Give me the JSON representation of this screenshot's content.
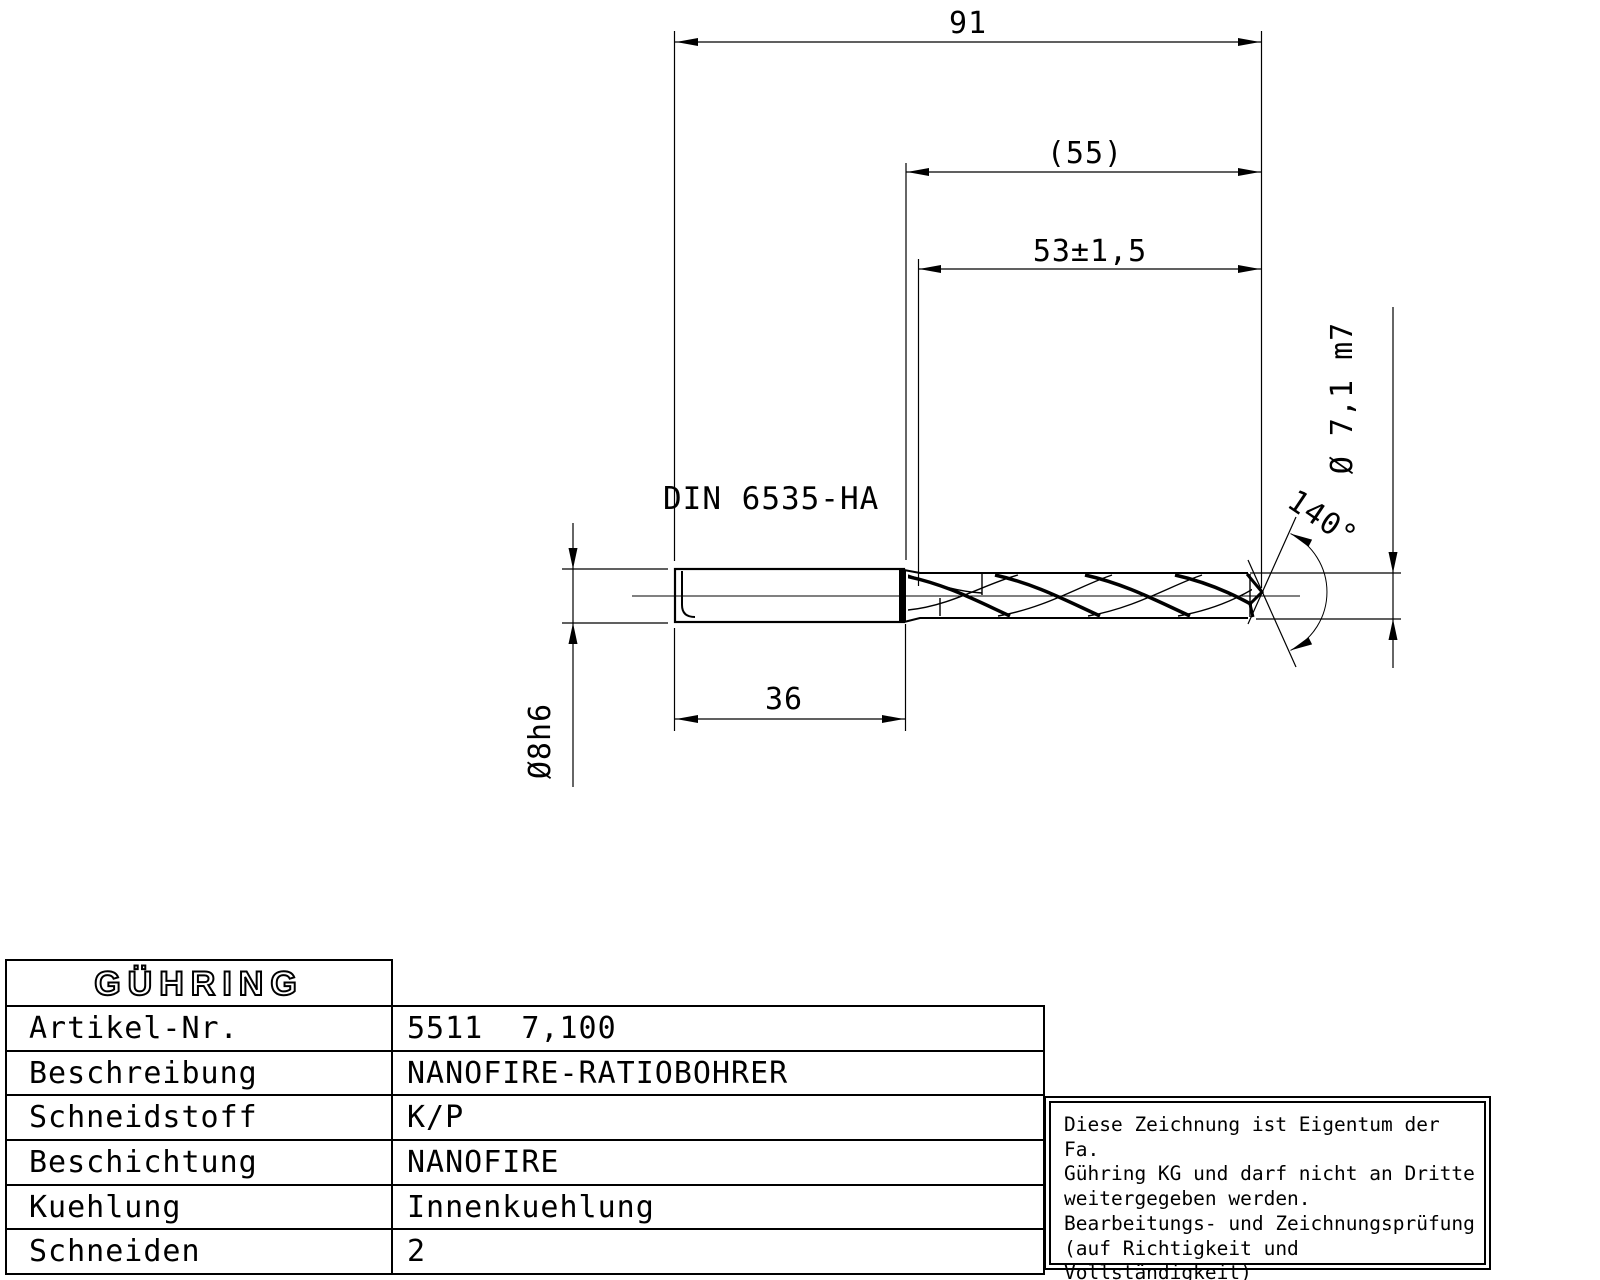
{
  "colors": {
    "ink": "#000000",
    "background": "#ffffff"
  },
  "drawing": {
    "dimensions": {
      "overall_length": "91",
      "flute_ref_length": "(55)",
      "flute_length_tol": "53±1,5",
      "point_angle": "140°",
      "drill_diameter": "Ø 7,1 m7",
      "shank_diameter": "Ø8h6",
      "shank_length": "36",
      "shank_norm": "DIN 6535-HA"
    }
  },
  "title_block": {
    "logo": "GÜHRING",
    "rows": [
      {
        "label": "Artikel-Nr.",
        "value": "5511  7,100"
      },
      {
        "label": "Beschreibung",
        "value": "NANOFIRE-RATIOBOHRER"
      },
      {
        "label": "Schneidstoff",
        "value": "K/P"
      },
      {
        "label": "Beschichtung",
        "value": "NANOFIRE"
      },
      {
        "label": "Kuehlung",
        "value": "Innenkuehlung"
      },
      {
        "label": "Schneiden",
        "value": "2"
      }
    ]
  },
  "disclaimer": {
    "text": "Diese Zeichnung ist Eigentum der Fa.\nGühring KG und darf nicht an Dritte\nweitergegeben werden.\nBearbeitungs- und Zeichnungsprüfung\n(auf Richtigkeit und Vollständigkeit)\nobliegen dem Kunden."
  }
}
